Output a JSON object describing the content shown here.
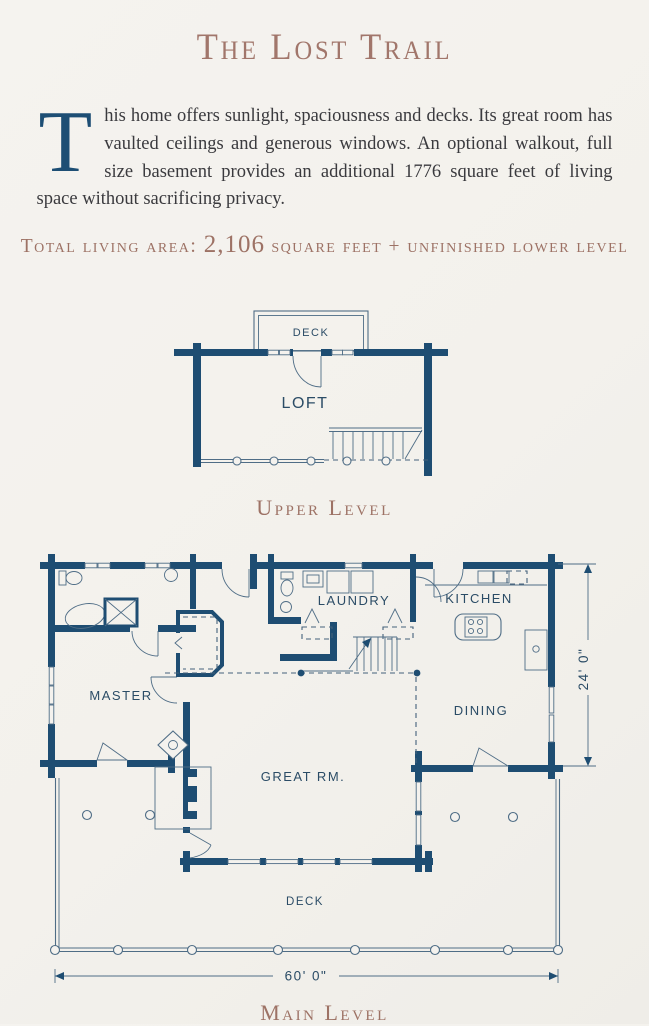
{
  "page": {
    "title": "The Lost Trail",
    "intro": {
      "dropcap": "T",
      "text": "his home offers sunlight, spaciousness and decks. Its great room has vaulted ceilings and generous windows. An optional walkout, full size basement provides an additional 1776 square feet of living space without sacrificing privacy."
    },
    "total_area": {
      "label": "Total living area:",
      "value": "2,106",
      "suffix": "square feet + unfinished lower level"
    }
  },
  "upper_level": {
    "caption": "Upper Level",
    "labels": {
      "deck": "DECK",
      "loft": "LOFT"
    }
  },
  "main_level": {
    "caption": "Main Level",
    "labels": {
      "master": "MASTER",
      "laundry": "LAUNDRY",
      "kitchen": "KITCHEN",
      "dining": "DINING",
      "great_room": "GREAT RM.",
      "deck": "DECK"
    },
    "dimensions": {
      "depth": "24' 0\"",
      "width": "60' 0\""
    }
  },
  "colors": {
    "paper": "#f4f2ee",
    "wall_blue": "#1e4d72",
    "accent_brown": "#a1766b",
    "line_blue": "#4f6d86",
    "label_blue": "#2b4c66",
    "body_ink": "#3a3a3e"
  }
}
